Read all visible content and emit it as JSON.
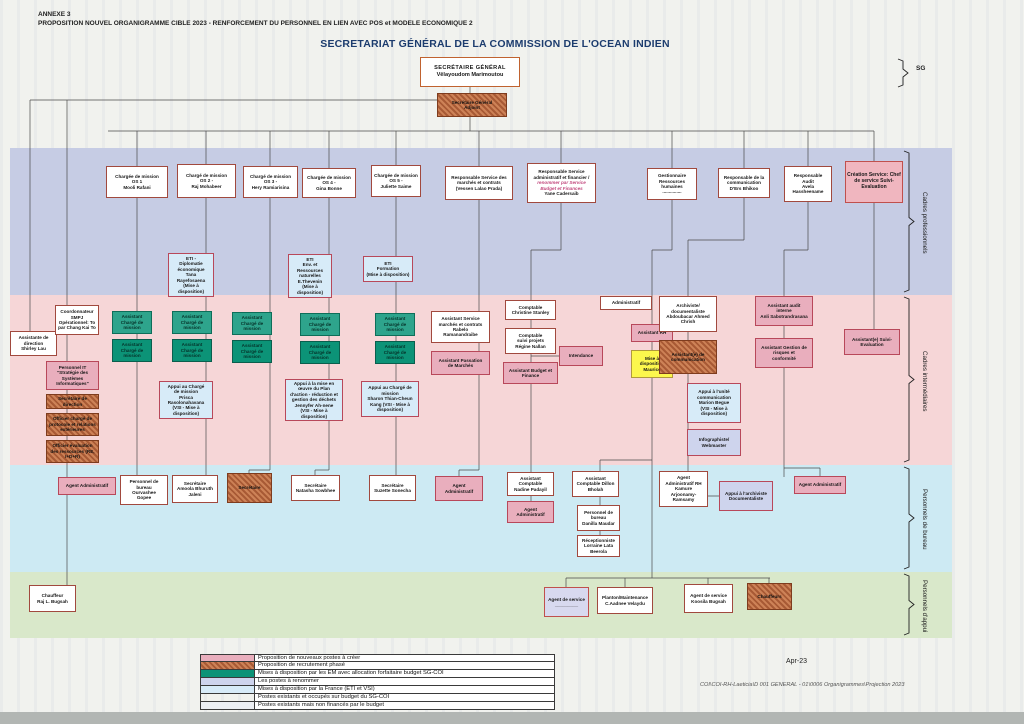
{
  "page": {
    "annexe": "ANNEXE 3",
    "subtitle": "PROPOSITION NOUVEL ORGANIGRAMME  CIBLE 2023 - RENFORCEMENT DU PERSONNEL EN LIEN AVEC POS et MODELE ECONOMIQUE 2",
    "title": "SECRETARIAT GÉNÉRAL DE LA COMMISSION DE L'OCEAN INDIEN",
    "date": "Apr-23",
    "footer_path": "COI\\COI-RH-Laeticia\\D 001 GENERAL - 01\\0006 Organigrammes\\Projection 2023",
    "sg_bracket_label": "SG"
  },
  "bands": [
    {
      "label": "Cadres professionnels",
      "color": "#c6cce4",
      "y": 148,
      "h": 147
    },
    {
      "label": "Cadres intermédiaires",
      "color": "#f6d6d7",
      "y": 295,
      "h": 170
    },
    {
      "label": "Personnels de bureau",
      "color": "#cdeaf3",
      "y": 465,
      "h": 107
    },
    {
      "label": "Personnels d'appui",
      "color": "#d9e8ca",
      "y": 572,
      "h": 66
    }
  ],
  "legend": {
    "rows": [
      {
        "style": "pink",
        "label": "Proposition de nouveaux postes à créer"
      },
      {
        "style": "hatch",
        "label": "Proposition de recrutement phasé"
      },
      {
        "style": "tealB",
        "label": "Mises à disposition par les EM avec allocation forfaitaire budget SG-COI"
      },
      {
        "style": "lav",
        "label": "Les postes à renommer"
      },
      {
        "style": "blue",
        "label": "Mises à disposition par la France (ETI et VSI)"
      },
      {
        "style": "white",
        "label": "Postes existants et occupés sur budget du SG-COI"
      },
      {
        "style": "gray",
        "label": "Postes existants mais non financés par le budget"
      }
    ]
  },
  "boxes": [
    {
      "id": "secretaire-general",
      "cls": "sg",
      "x": 420,
      "y": 57,
      "w": 100,
      "h": 30,
      "lines": [
        "SECRÉTAIRE GÉNÉRAL",
        "",
        "Vêlayoudom Marimoutou"
      ]
    },
    {
      "id": "secretaire-general-adjoint",
      "cls": "hatch",
      "x": 437,
      "y": 93,
      "w": 70,
      "h": 24,
      "lines": [
        "Secrétaire Général",
        "Adjoint"
      ]
    },
    {
      "id": "charge-mission-os1",
      "cls": "white",
      "x": 106,
      "y": 166,
      "w": 62,
      "h": 32,
      "lines": [
        "Chargée de mission",
        "OS 1",
        "Mooli Rafani"
      ]
    },
    {
      "id": "charge-mission-os2",
      "cls": "white",
      "x": 177,
      "y": 164,
      "w": 59,
      "h": 34,
      "lines": [
        "Chargé de mission",
        "OS 2 -",
        "Raj Mohabeer"
      ]
    },
    {
      "id": "charge-mission-os3",
      "cls": "white",
      "x": 243,
      "y": 166,
      "w": 55,
      "h": 32,
      "lines": [
        "Chargé de mission",
        "OS 3 -",
        "Hery Ramiarisina"
      ]
    },
    {
      "id": "charge-mission-os4",
      "cls": "white",
      "x": 302,
      "y": 168,
      "w": 54,
      "h": 30,
      "lines": [
        "Chargée de mission",
        "OS 4 -",
        "Gina Bonne"
      ]
    },
    {
      "id": "charge-mission-os5",
      "cls": "white",
      "x": 371,
      "y": 165,
      "w": 50,
      "h": 32,
      "lines": [
        "Chargée de mission",
        "OS 5 -",
        "Juliette Saime"
      ]
    },
    {
      "id": "responsable-marches-contrats",
      "cls": "white",
      "x": 445,
      "y": 166,
      "w": 68,
      "h": 34,
      "lines": [
        "Responsable Service des",
        "marchés et contrats",
        "(Vessen Lalao Prada)"
      ]
    },
    {
      "id": "responsable-administratif-financier",
      "cls": "white",
      "x": 527,
      "y": 163,
      "w": 69,
      "h": 40,
      "lines": [
        "Responsable Service",
        "administratif et financier /",
        "~renommer par Service",
        "~Budget et Finances",
        "Yane Cadersaib"
      ]
    },
    {
      "id": "gestionnaire-rh",
      "cls": "white",
      "x": 647,
      "y": 168,
      "w": 50,
      "h": 32,
      "lines": [
        "Gestionnaire",
        "Ressources",
        "humaines",
        "..............."
      ]
    },
    {
      "id": "responsable-communication",
      "cls": "white",
      "x": 718,
      "y": 168,
      "w": 52,
      "h": 30,
      "lines": [
        "Responsable de la",
        "communication",
        "D'Ers Bhikoo"
      ]
    },
    {
      "id": "responsable-audit",
      "cls": "white",
      "x": 784,
      "y": 166,
      "w": 48,
      "h": 36,
      "lines": [
        "Responsable",
        "Audit",
        "Avela",
        "Hassheename"
      ]
    },
    {
      "id": "creation-service-suivi-evaluation",
      "cls": "pinkbig",
      "x": 845,
      "y": 161,
      "w": 58,
      "h": 42,
      "lines": [
        "Création Service: Chef",
        "de service Suivi-",
        "Evaluation"
      ]
    },
    {
      "id": "eti-diplomatie-economique",
      "cls": "blue",
      "x": 168,
      "y": 253,
      "w": 46,
      "h": 44,
      "lines": [
        "ETI -",
        "Diplomatie",
        "économique",
        "Tana",
        "Rayefosaena",
        "(Mise à disposition)"
      ]
    },
    {
      "id": "eti-environnement-ressources",
      "cls": "blue",
      "x": 288,
      "y": 254,
      "w": 44,
      "h": 44,
      "lines": [
        "ETI",
        "Env. et",
        "Ressources",
        "naturelles",
        "E.Thevenin",
        "(Mise à disposition)"
      ]
    },
    {
      "id": "eti-formation",
      "cls": "blue",
      "x": 363,
      "y": 256,
      "w": 50,
      "h": 26,
      "lines": [
        "ETI",
        "Formation",
        "(Mise à disposition)"
      ]
    },
    {
      "id": "assistante-direction",
      "cls": "white",
      "x": 10,
      "y": 331,
      "w": 47,
      "h": 25,
      "lines": [
        "Assistante de",
        "direction",
        "Shirley Lau"
      ]
    },
    {
      "id": "coordonnateur-smpj",
      "cls": "white",
      "x": 55,
      "y": 305,
      "w": 44,
      "h": 30,
      "lines": [
        "Coordonnateur",
        "SMPJ",
        "Opérationnel: To",
        "par Chang Kai To"
      ]
    },
    {
      "id": "personnel-it",
      "cls": "pink",
      "x": 46,
      "y": 361,
      "w": 53,
      "h": 29,
      "lines": [
        "Personnel IT",
        "\"Stratégie des",
        "Systèmes",
        "Informatiques\""
      ]
    },
    {
      "id": "secretaire-de-direction",
      "cls": "hatch",
      "x": 46,
      "y": 394,
      "w": 53,
      "h": 15,
      "lines": [
        "Secrétaire de",
        "direction"
      ]
    },
    {
      "id": "officier-protocole",
      "cls": "hatch",
      "x": 46,
      "y": 413,
      "w": 53,
      "h": 23,
      "lines": [
        "Officier chargé de",
        "protocole et relations",
        "extérieures"
      ]
    },
    {
      "id": "officier-evaluation-ressources",
      "cls": "hatch",
      "x": 46,
      "y": 440,
      "w": 53,
      "h": 23,
      "lines": [
        "Officier évaluation",
        "des ressources (RE,",
        "I+D+R)"
      ]
    },
    {
      "id": "assistant-cm1-a",
      "cls": "tealA",
      "x": 112,
      "y": 311,
      "w": 40,
      "h": 23,
      "lines": [
        "Assistant",
        "Chargé de",
        "mission"
      ]
    },
    {
      "id": "assistant-cm1-b",
      "cls": "tealB",
      "x": 112,
      "y": 339,
      "w": 40,
      "h": 23,
      "lines": [
        "Assistant",
        "Chargé de",
        "mission"
      ]
    },
    {
      "id": "assistant-cm2-a",
      "cls": "tealA",
      "x": 172,
      "y": 311,
      "w": 40,
      "h": 23,
      "lines": [
        "Assistant",
        "Chargé de",
        "mission"
      ]
    },
    {
      "id": "assistant-cm2-b",
      "cls": "tealB",
      "x": 172,
      "y": 339,
      "w": 40,
      "h": 23,
      "lines": [
        "Assistant",
        "Chargé de",
        "mission"
      ]
    },
    {
      "id": "assistant-cm3-a",
      "cls": "tealA",
      "x": 232,
      "y": 312,
      "w": 40,
      "h": 23,
      "lines": [
        "Assistant",
        "Chargé de",
        "mission"
      ]
    },
    {
      "id": "assistant-cm3-b",
      "cls": "tealB",
      "x": 232,
      "y": 340,
      "w": 40,
      "h": 23,
      "lines": [
        "Assistant",
        "Chargé de",
        "mission"
      ]
    },
    {
      "id": "assistant-cm4-a",
      "cls": "tealA",
      "x": 300,
      "y": 313,
      "w": 40,
      "h": 23,
      "lines": [
        "Assistant",
        "Chargé de",
        "mission"
      ]
    },
    {
      "id": "assistant-cm4-b",
      "cls": "tealB",
      "x": 300,
      "y": 341,
      "w": 40,
      "h": 23,
      "lines": [
        "Assistant",
        "Chargé de",
        "mission"
      ]
    },
    {
      "id": "assistant-cm5-a",
      "cls": "tealA",
      "x": 375,
      "y": 313,
      "w": 40,
      "h": 23,
      "lines": [
        "Assistant",
        "Chargé de",
        "mission"
      ]
    },
    {
      "id": "assistant-cm5-b",
      "cls": "tealB",
      "x": 375,
      "y": 341,
      "w": 40,
      "h": 23,
      "lines": [
        "Assistant",
        "Chargé de",
        "mission"
      ]
    },
    {
      "id": "appui-charge-mission-1",
      "cls": "blue",
      "x": 159,
      "y": 381,
      "w": 54,
      "h": 38,
      "lines": [
        "Appui au Chargé",
        "de mission",
        "Prisca",
        "Rasolonahavana",
        "(VSI - Mise à",
        "disposition)"
      ]
    },
    {
      "id": "appui-plan-action-dechets",
      "cls": "blue",
      "x": 285,
      "y": 379,
      "w": 58,
      "h": 42,
      "lines": [
        "Appui à la mise en",
        "œuvre du Plan",
        "d'action - réduction et",
        "gestion des déchets",
        "Jennyfer Ah-nene",
        "(VSI - Mise à disposition)"
      ]
    },
    {
      "id": "appui-charge-mission-2",
      "cls": "blue",
      "x": 361,
      "y": 381,
      "w": 58,
      "h": 36,
      "lines": [
        "Appui au Chargé de",
        "mission",
        "Sharon Thian-Cheun",
        "Kang (VSI - Mise à",
        "disposition)"
      ]
    },
    {
      "id": "assistant-service-marches",
      "cls": "white",
      "x": 431,
      "y": 311,
      "w": 59,
      "h": 32,
      "lines": [
        "Assistant Service",
        "marchés et contrats",
        "Rabelo",
        "Ramanandraibe"
      ]
    },
    {
      "id": "assistant-passation-marches",
      "cls": "pink",
      "x": 431,
      "y": 351,
      "w": 59,
      "h": 24,
      "lines": [
        "Assistant Passation",
        "de Marchés"
      ]
    },
    {
      "id": "comptable",
      "cls": "white",
      "x": 505,
      "y": 300,
      "w": 51,
      "h": 20,
      "lines": [
        "Comptable",
        "Christine Stanley"
      ]
    },
    {
      "id": "comptable-suivi-projets",
      "cls": "white",
      "x": 505,
      "y": 328,
      "w": 51,
      "h": 26,
      "lines": [
        "Comptable",
        "suivi projets",
        "Régine Nallan"
      ]
    },
    {
      "id": "assistant-budget-finance",
      "cls": "pink",
      "x": 503,
      "y": 362,
      "w": 55,
      "h": 22,
      "lines": [
        "Assistant Budget et",
        "Finance"
      ]
    },
    {
      "id": "administratif",
      "cls": "white",
      "x": 600,
      "y": 296,
      "w": 52,
      "h": 14,
      "lines": [
        "Administratif"
      ]
    },
    {
      "id": "assistant-rh",
      "cls": "pink",
      "x": 631,
      "y": 324,
      "w": 42,
      "h": 18,
      "lines": [
        "Assistant RH"
      ]
    },
    {
      "id": "intendance",
      "cls": "pink",
      "x": 559,
      "y": 346,
      "w": 44,
      "h": 20,
      "lines": [
        "Intendance"
      ]
    },
    {
      "id": "mise-a-disposition-maurice",
      "cls": "yellow",
      "x": 631,
      "y": 350,
      "w": 42,
      "h": 28,
      "lines": [
        "Mise à",
        "disposition",
        "Maurice"
      ]
    },
    {
      "id": "archiviste-documentaliste",
      "cls": "white",
      "x": 659,
      "y": 296,
      "w": 58,
      "h": 36,
      "lines": [
        "Archiviste/",
        "documentaliste",
        "Abdoubacar Ahmed",
        "Chrish"
      ]
    },
    {
      "id": "assistant-communication",
      "cls": "hatch",
      "x": 659,
      "y": 340,
      "w": 58,
      "h": 34,
      "lines": [
        "Assistant(e) de",
        "communication"
      ]
    },
    {
      "id": "appui-unite-communication",
      "cls": "blue",
      "x": 687,
      "y": 383,
      "w": 54,
      "h": 40,
      "lines": [
        "Appui à l'unité",
        "communication",
        "Marion Begue",
        "(VSI - Mise à",
        "disposition)"
      ]
    },
    {
      "id": "infographiste-webmaster",
      "cls": "lav",
      "x": 687,
      "y": 429,
      "w": 54,
      "h": 27,
      "lines": [
        "Infographiste/",
        "Webmaster"
      ]
    },
    {
      "id": "assistant-audit-interne",
      "cls": "pink",
      "x": 755,
      "y": 296,
      "w": 58,
      "h": 30,
      "lines": [
        "Assistant audit",
        "interne",
        "Anli Sabotrandrasana"
      ]
    },
    {
      "id": "assistant-gestion-risques",
      "cls": "pink",
      "x": 755,
      "y": 338,
      "w": 58,
      "h": 30,
      "lines": [
        "Assistant Gestion de",
        "risques et",
        "conformité"
      ]
    },
    {
      "id": "assistant-suivi-evaluation",
      "cls": "pink",
      "x": 844,
      "y": 329,
      "w": 56,
      "h": 26,
      "lines": [
        "Assistant(e) Suivi-",
        "Evaluation"
      ]
    },
    {
      "id": "agent-administratif-1",
      "cls": "pink",
      "x": 58,
      "y": 477,
      "w": 58,
      "h": 18,
      "lines": [
        "Agent Administratif"
      ]
    },
    {
      "id": "personnel-bureau-1",
      "cls": "white",
      "x": 120,
      "y": 475,
      "w": 48,
      "h": 30,
      "lines": [
        "Personnel de",
        "bureau",
        "Ourvashee",
        "Gopee"
      ]
    },
    {
      "id": "secretaire-1",
      "cls": "white",
      "x": 172,
      "y": 475,
      "w": 46,
      "h": 28,
      "lines": [
        "Secrétaire",
        "Amoola Bhuruth",
        "Jaleni"
      ]
    },
    {
      "id": "secretaire-nouvelle",
      "cls": "hatch",
      "x": 227,
      "y": 473,
      "w": 45,
      "h": 30,
      "lines": [
        "Secrétaire"
      ]
    },
    {
      "id": "secretaire-2",
      "cls": "white",
      "x": 291,
      "y": 475,
      "w": 49,
      "h": 26,
      "lines": [
        "Secrétaire",
        "Natasha Sowbhee"
      ]
    },
    {
      "id": "secretaire-3",
      "cls": "white",
      "x": 369,
      "y": 475,
      "w": 47,
      "h": 26,
      "lines": [
        "Secrétaire",
        "Suzette Sonecha"
      ]
    },
    {
      "id": "agent-administratif-2",
      "cls": "pink",
      "x": 435,
      "y": 476,
      "w": 48,
      "h": 25,
      "lines": [
        "Agent",
        "Administratif"
      ]
    },
    {
      "id": "assistant-comptable-1",
      "cls": "white",
      "x": 507,
      "y": 472,
      "w": 47,
      "h": 24,
      "lines": [
        "Assistant",
        "Comptable",
        "Nadine Padayil"
      ]
    },
    {
      "id": "agent-administratif-3",
      "cls": "pink",
      "x": 507,
      "y": 501,
      "w": 47,
      "h": 22,
      "lines": [
        "Agent",
        "Administratif"
      ]
    },
    {
      "id": "assistant-comptable-2",
      "cls": "white",
      "x": 572,
      "y": 471,
      "w": 47,
      "h": 26,
      "lines": [
        "Assistant",
        "Comptable Dillon",
        "Bholah"
      ]
    },
    {
      "id": "personnel-bureau-2",
      "cls": "white",
      "x": 577,
      "y": 505,
      "w": 43,
      "h": 26,
      "lines": [
        "Personnel de",
        "bureau",
        "Danilla Maudar"
      ]
    },
    {
      "id": "receptionniste",
      "cls": "white",
      "x": 577,
      "y": 535,
      "w": 43,
      "h": 22,
      "lines": [
        "Réceptionniste",
        "Lorraine Lata",
        "Beerola"
      ]
    },
    {
      "id": "agent-administratif-rh",
      "cls": "white",
      "x": 659,
      "y": 471,
      "w": 49,
      "h": 36,
      "lines": [
        "Agent",
        "Administratif RH",
        "Kamure",
        "Arjoonamy-",
        "Ramsamy"
      ]
    },
    {
      "id": "appui-archiviste",
      "cls": "lav",
      "x": 719,
      "y": 481,
      "w": 54,
      "h": 30,
      "lines": [
        "Appui à l'archiviste",
        "Documentaliste"
      ]
    },
    {
      "id": "agent-administratif-4",
      "cls": "pink",
      "x": 794,
      "y": 476,
      "w": 52,
      "h": 18,
      "lines": [
        "Agent Administratif"
      ]
    },
    {
      "id": "chauffeur",
      "cls": "white",
      "x": 29,
      "y": 585,
      "w": 47,
      "h": 27,
      "lines": [
        "Chauffeur",
        "Raj L. Bugsah"
      ]
    },
    {
      "id": "agent-de-service-1",
      "cls": "lavr",
      "x": 544,
      "y": 587,
      "w": 45,
      "h": 30,
      "lines": [
        "Agent de service",
        "_________"
      ]
    },
    {
      "id": "planton-maintenance",
      "cls": "white",
      "x": 597,
      "y": 587,
      "w": 56,
      "h": 27,
      "lines": [
        "Planton/Maintenance",
        "C.Aadnee Velaydu"
      ]
    },
    {
      "id": "agent-de-service-2",
      "cls": "white",
      "x": 684,
      "y": 584,
      "w": 49,
      "h": 29,
      "lines": [
        "Agent de service",
        "Koosila Bugsah"
      ]
    },
    {
      "id": "chauffeurs",
      "cls": "hatch",
      "x": 747,
      "y": 583,
      "w": 45,
      "h": 27,
      "lines": [
        "Chauffeurs"
      ]
    }
  ]
}
